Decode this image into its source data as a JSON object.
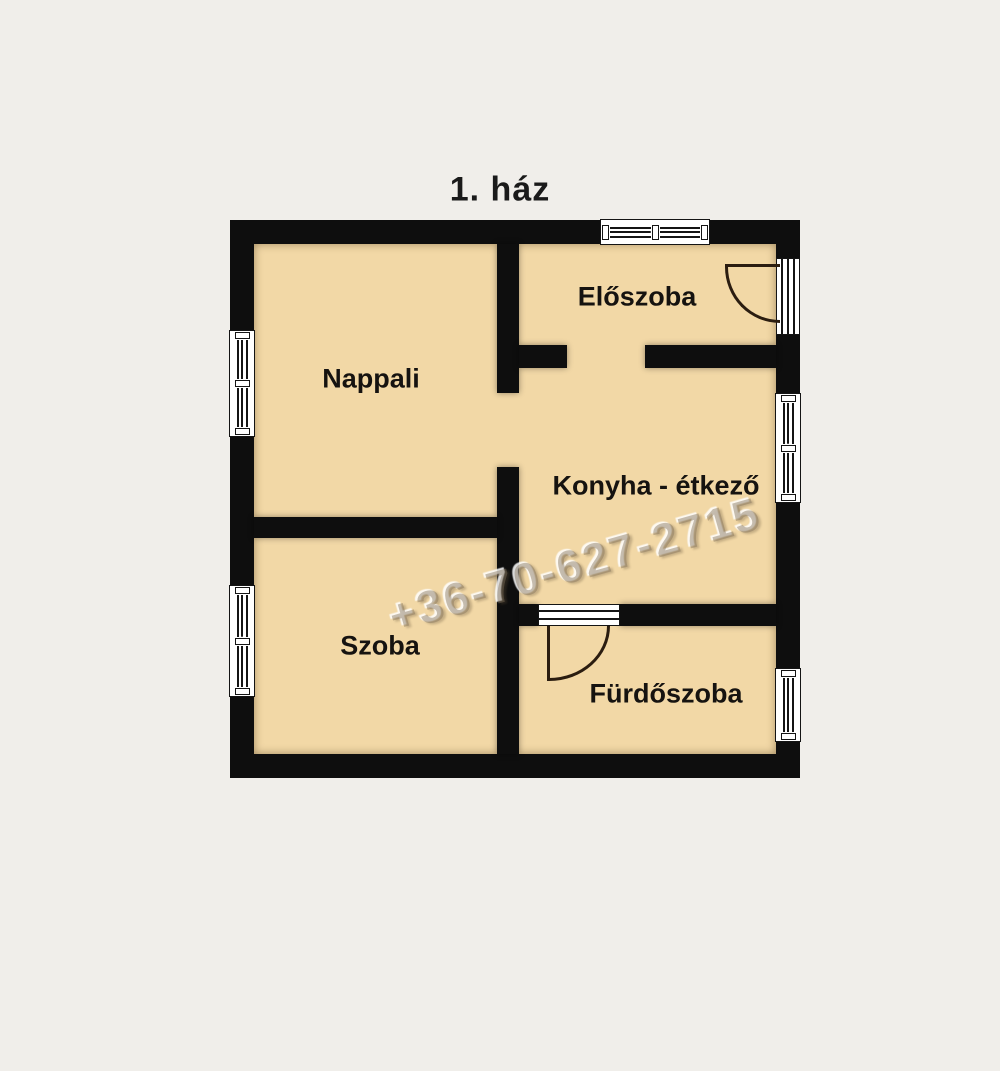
{
  "title": "1. ház",
  "watermark": "+36-70-627-2715",
  "rooms": {
    "nappali": "Nappali",
    "eloszoba": "Előszoba",
    "konyha": "Konyha - étkező",
    "szoba": "Szoba",
    "furdoszoba": "Fürdőszoba"
  },
  "colors": {
    "background": "#f0eeea",
    "floor": "#f2d8a6",
    "wall": "#0e0e0e",
    "label": "#161310"
  }
}
